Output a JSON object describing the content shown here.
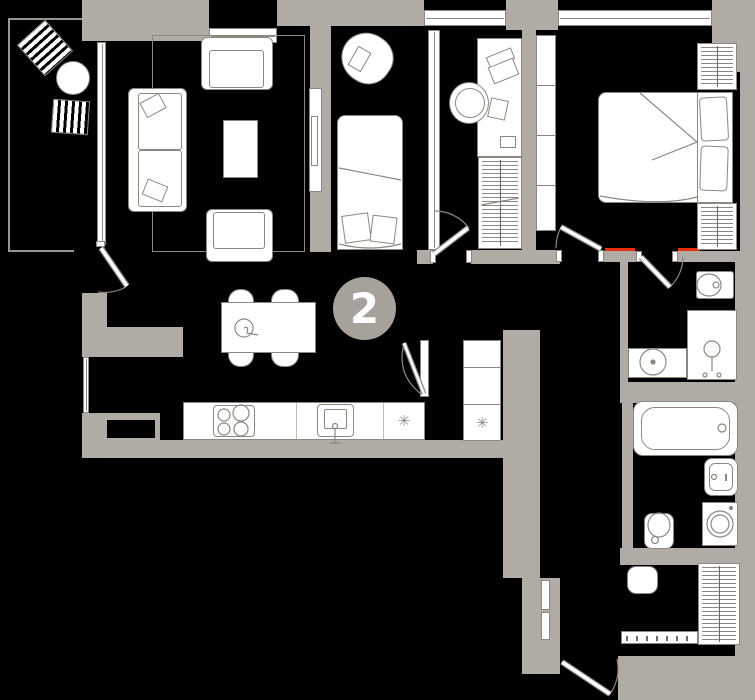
{
  "badge": {
    "value": "2"
  },
  "symbols": {
    "snowflake": "✳"
  },
  "colors": {
    "background": "#000000",
    "wall": "#b1aba6",
    "outline": "#8d8781",
    "furniture_fill": "#ffffff",
    "badge_fill": "#a7a19c",
    "badge_text": "#ffffff",
    "accent_red": "#e82f12"
  }
}
